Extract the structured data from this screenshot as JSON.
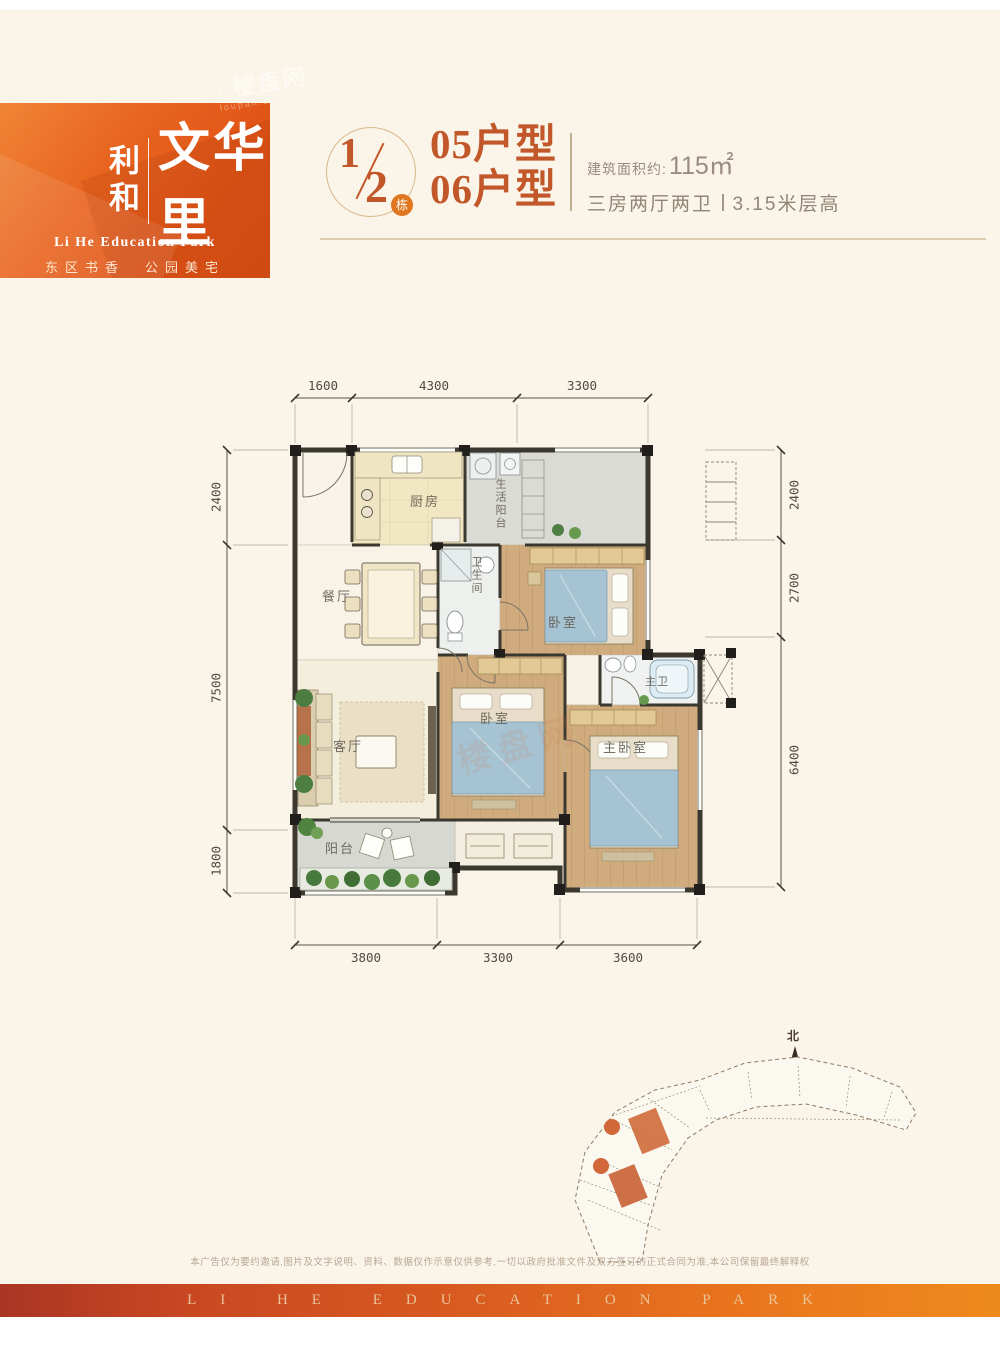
{
  "brand": {
    "name_left": "利和",
    "name_main": "文华里",
    "subtitle_en": "Li He Education Park",
    "tagline": "东区书香　公园美宅",
    "watermark": "楼盘网",
    "watermark_sub": "loupan.com",
    "watermark_house": "⌂"
  },
  "header": {
    "block_numerator": "1",
    "block_denominator": "2",
    "block_badge": "栋",
    "unit_line1": "05户型",
    "unit_line2": "06户型",
    "area_label": "建筑面积约:",
    "area_value": "115㎡",
    "spec_rooms": "三房两厅两卫",
    "spec_height": "3.15米层高"
  },
  "plan": {
    "dims_top": [
      "1600",
      "4300",
      "3300"
    ],
    "dims_left": [
      "2400",
      "7500",
      "1800"
    ],
    "dims_right": [
      "2400",
      "2700",
      "6400"
    ],
    "dims_bottom": [
      "3800",
      "3300",
      "3600"
    ],
    "rooms": {
      "kitchen": "厨房",
      "service_balcony": "生活阳台",
      "dining": "餐厅",
      "bathroom": "卫生间",
      "bedroom_top": "卧室",
      "living": "客厅",
      "bedroom_mid": "卧室",
      "master_bath": "主卫",
      "master_bedroom": "主卧室",
      "balcony": "阳台"
    }
  },
  "siteplan": {
    "north_label": "北"
  },
  "footer": {
    "disclaimer": "本广告仅为要约邀请,图片及文字说明、资料、数据仅作示意仅供参考,一切以政府批准文件及双方签订的正式合同为准,本公司保留最终解释权",
    "band_text": "LI HE EDUCATION PARK"
  },
  "colors": {
    "brand_orange": "#e2591e",
    "title_orange": "#c2582a",
    "band_left": "#a93524",
    "band_right": "#ee8a1d",
    "page_cream": "#fbf5e9",
    "wall": "#3b382f",
    "wood_floor": "#cfab7e",
    "bed_blue": "#a6c3d3"
  }
}
